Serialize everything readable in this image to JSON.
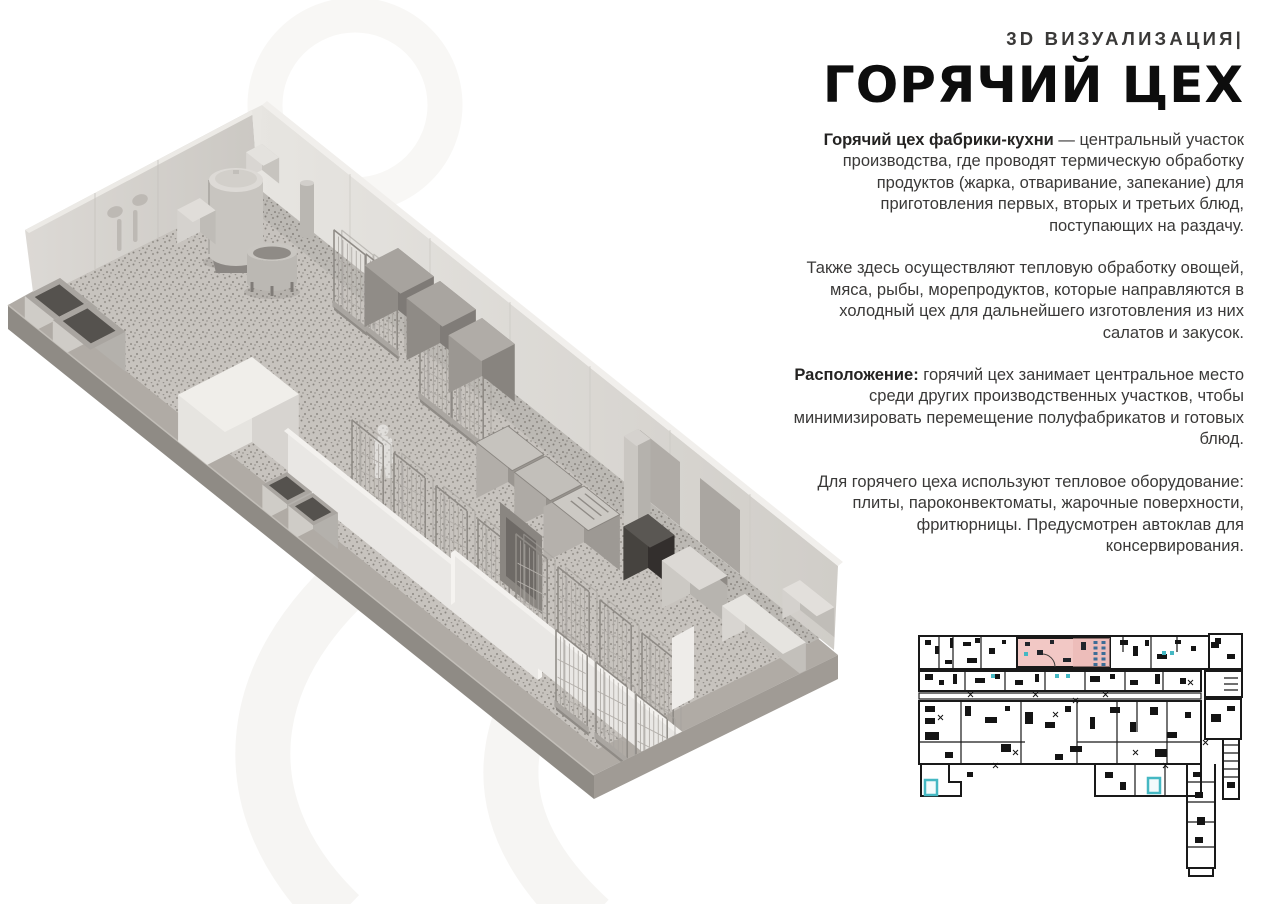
{
  "header": {
    "kicker": "3D ВИЗУАЛИЗАЦИЯ|",
    "title": "ГОРЯЧИЙ ЦЕХ"
  },
  "paragraphs": [
    {
      "bold": "Горячий цех фабрики-кухни",
      "text": " — центральный участок производства, где проводят термическую обработку продуктов (жарка, отваривание, запекание) для приготовления первых, вторых и третьих блюд, поступающих на раздачу."
    },
    {
      "bold": "",
      "text": "Также здесь осуществляют тепловую обработку овощей, мяса, рыбы, морепродуктов, которые направляются в холодный цех для дальнейшего изготовления из них салатов и закусок."
    },
    {
      "bold": "Расположение:",
      "text": " горячий цех занимает центральное место среди других производственных участков, чтобы минимизировать перемещение полуфабрикатов и готовых блюд."
    },
    {
      "bold": "",
      "text": "Для горячего цеха используют тепловое оборудование: плиты, пароконвектоматы, жарочные поверхности, фритюрницы. Предусмотрен автоклав для консервирования."
    }
  ],
  "colors": {
    "title_color": "#0d0d0d",
    "body_color": "#3a3938",
    "highlight_pink": "#f2c8c5",
    "highlight_pink_dark": "#eab4b0",
    "accent_teal": "#45b8c3",
    "plan_line": "#191919"
  }
}
